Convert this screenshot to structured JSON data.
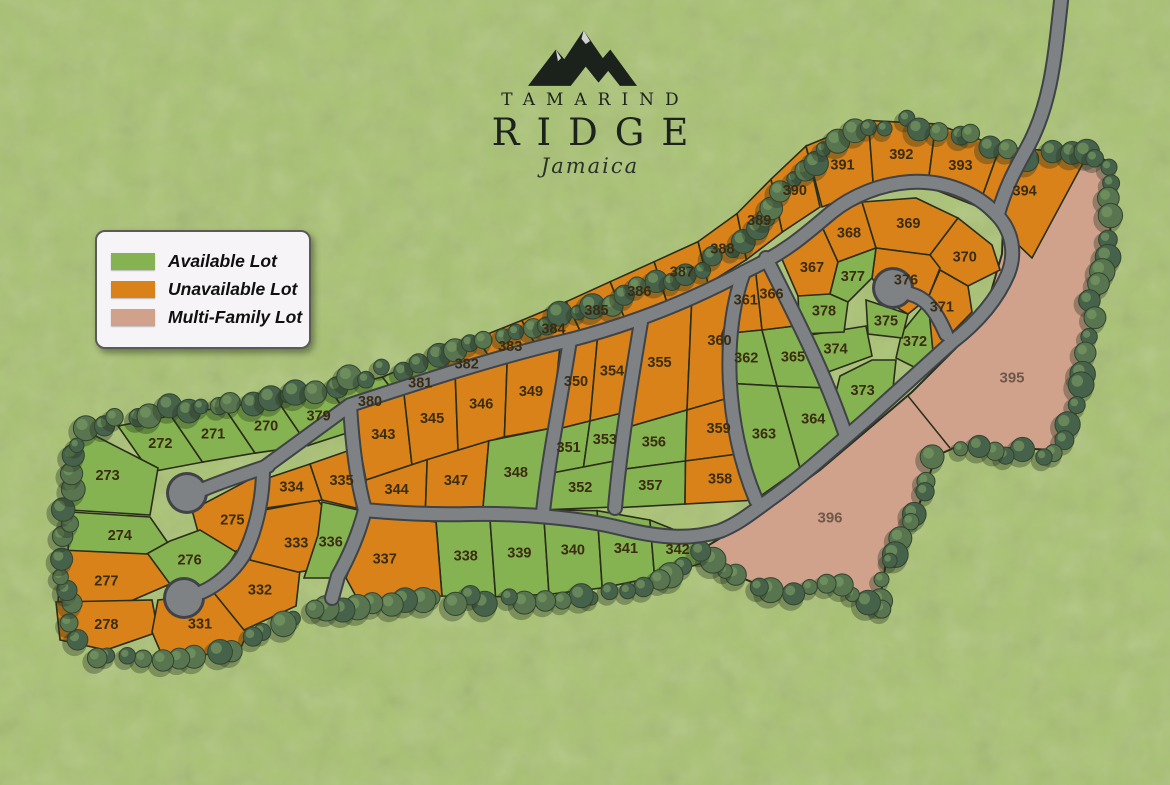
{
  "logo": {
    "name_line1": "TAMARIND",
    "name_line2": "RIDGE",
    "script": "Jamaica"
  },
  "legend": {
    "items": [
      {
        "key": "available",
        "label": "Available Lot",
        "color": "#85b351"
      },
      {
        "key": "unavailable",
        "label": "Unavailable Lot",
        "color": "#d9821a"
      },
      {
        "key": "multifamily",
        "label": "Multi-Family Lot",
        "color": "#d0a28c"
      }
    ]
  },
  "map": {
    "lots": [
      {
        "number": "270",
        "status": "available"
      },
      {
        "number": "271",
        "status": "available"
      },
      {
        "number": "272",
        "status": "available"
      },
      {
        "number": "273",
        "status": "available"
      },
      {
        "number": "274",
        "status": "available"
      },
      {
        "number": "275",
        "status": "unavailable"
      },
      {
        "number": "276",
        "status": "available"
      },
      {
        "number": "277",
        "status": "unavailable"
      },
      {
        "number": "278",
        "status": "unavailable"
      },
      {
        "number": "331",
        "status": "unavailable"
      },
      {
        "number": "332",
        "status": "unavailable"
      },
      {
        "number": "333",
        "status": "unavailable"
      },
      {
        "number": "334",
        "status": "unavailable"
      },
      {
        "number": "335",
        "status": "unavailable"
      },
      {
        "number": "336",
        "status": "available"
      },
      {
        "number": "337",
        "status": "unavailable"
      },
      {
        "number": "338",
        "status": "available"
      },
      {
        "number": "339",
        "status": "available"
      },
      {
        "number": "340",
        "status": "available"
      },
      {
        "number": "341",
        "status": "available"
      },
      {
        "number": "342",
        "status": "available"
      },
      {
        "number": "343",
        "status": "unavailable"
      },
      {
        "number": "344",
        "status": "unavailable"
      },
      {
        "number": "345",
        "status": "unavailable"
      },
      {
        "number": "346",
        "status": "unavailable"
      },
      {
        "number": "347",
        "status": "unavailable"
      },
      {
        "number": "348",
        "status": "available"
      },
      {
        "number": "349",
        "status": "unavailable"
      },
      {
        "number": "350",
        "status": "unavailable"
      },
      {
        "number": "351",
        "status": "available"
      },
      {
        "number": "352",
        "status": "available"
      },
      {
        "number": "353",
        "status": "available"
      },
      {
        "number": "354",
        "status": "unavailable"
      },
      {
        "number": "355",
        "status": "unavailable"
      },
      {
        "number": "356",
        "status": "available"
      },
      {
        "number": "357",
        "status": "available"
      },
      {
        "number": "358",
        "status": "unavailable"
      },
      {
        "number": "359",
        "status": "unavailable"
      },
      {
        "number": "360",
        "status": "unavailable"
      },
      {
        "number": "361",
        "status": "unavailable"
      },
      {
        "number": "362",
        "status": "available"
      },
      {
        "number": "363",
        "status": "available"
      },
      {
        "number": "364",
        "status": "available"
      },
      {
        "number": "365",
        "status": "available"
      },
      {
        "number": "366",
        "status": "unavailable"
      },
      {
        "number": "367",
        "status": "unavailable"
      },
      {
        "number": "368",
        "status": "unavailable"
      },
      {
        "number": "369",
        "status": "unavailable"
      },
      {
        "number": "370",
        "status": "unavailable"
      },
      {
        "number": "371",
        "status": "unavailable"
      },
      {
        "number": "372",
        "status": "available"
      },
      {
        "number": "373",
        "status": "available"
      },
      {
        "number": "374",
        "status": "available"
      },
      {
        "number": "375",
        "status": "available"
      },
      {
        "number": "376",
        "status": "unavailable"
      },
      {
        "number": "377",
        "status": "available"
      },
      {
        "number": "378",
        "status": "available"
      },
      {
        "number": "379",
        "status": "available"
      },
      {
        "number": "380",
        "status": "available"
      },
      {
        "number": "381",
        "status": "available"
      },
      {
        "number": "382",
        "status": "unavailable"
      },
      {
        "number": "383",
        "status": "unavailable"
      },
      {
        "number": "384",
        "status": "unavailable"
      },
      {
        "number": "385",
        "status": "unavailable"
      },
      {
        "number": "386",
        "status": "unavailable"
      },
      {
        "number": "387",
        "status": "unavailable"
      },
      {
        "number": "388",
        "status": "unavailable"
      },
      {
        "number": "389",
        "status": "unavailable"
      },
      {
        "number": "390",
        "status": "unavailable"
      },
      {
        "number": "391",
        "status": "unavailable"
      },
      {
        "number": "392",
        "status": "unavailable"
      },
      {
        "number": "393",
        "status": "unavailable"
      },
      {
        "number": "394",
        "status": "unavailable"
      },
      {
        "number": "395",
        "status": "multifamily"
      },
      {
        "number": "396",
        "status": "multifamily"
      }
    ]
  },
  "colors": {
    "grass": "#a9c273",
    "road": "#7e8284",
    "road_edge": "#3f4347",
    "lot_line": "#2a2d1a",
    "label": "#3a2c10",
    "mf_label": "#6e5849",
    "tree": "#587550",
    "tree_dark": "#47624a",
    "tree_light": "#7a9a62",
    "tree_shadow": "#243320"
  }
}
